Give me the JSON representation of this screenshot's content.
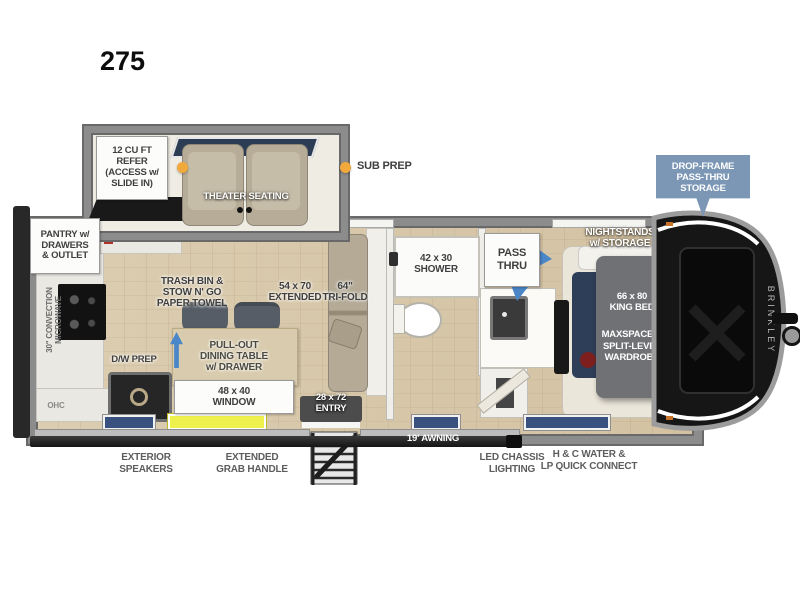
{
  "header": {
    "model": "275"
  },
  "legend": {
    "sub_prep": "SUB PREP"
  },
  "badge": {
    "drop_frame": [
      "DROP-FRAME",
      "PASS-THRU",
      "STORAGE"
    ]
  },
  "rooms": {
    "living": {
      "refer": [
        "12 CU FT",
        "REFER",
        "(ACCESS w/",
        "SLIDE IN)"
      ],
      "theater": "THEATER SEATING",
      "sofa_extended": [
        "54 x 70",
        "EXTENDED"
      ],
      "sofa_trifold": [
        "64\"",
        "TRI-FOLD"
      ]
    },
    "kitchen": {
      "pantry": [
        "PANTRY w/",
        "DRAWERS",
        "& OUTLET"
      ],
      "microwave": [
        "30\" CONVECTION",
        "MICROWAVE"
      ],
      "ohc": "OHC",
      "trash": [
        "TRASH BIN &",
        "STOW N' GO",
        "PAPER TOWEL"
      ],
      "dw_prep": "D/W PREP",
      "dining": [
        "PULL-OUT",
        "DINING TABLE",
        "w/ DRAWER"
      ],
      "window": [
        "48 x 40",
        "WINDOW"
      ]
    },
    "entry": {
      "door": [
        "28 x 72",
        "ENTRY"
      ]
    },
    "bath": {
      "shower": [
        "42 x 30",
        "SHOWER"
      ],
      "pass_thru": [
        "PASS",
        "THRU"
      ]
    },
    "bedroom": {
      "nightstands": [
        "NIGHTSTANDS",
        "w/ STORAGE"
      ],
      "bed": [
        "66 x 80",
        "KING BED"
      ],
      "wardrobe": [
        "MAXSPACE™",
        "SPLIT-LEVEL",
        "WARDROBE"
      ]
    }
  },
  "exterior": {
    "awning": "19' AWNING",
    "speakers": [
      "EXTERIOR",
      "SPEAKERS"
    ],
    "grab_handle": [
      "EXTENDED",
      "GRAB HANDLE"
    ],
    "chassis_lighting": [
      "LED CHASSIS",
      "LIGHTING"
    ],
    "water": [
      "H & C WATER &",
      "LP QUICK CONNECT"
    ],
    "brand": "BRINKLEY"
  },
  "colors": {
    "accent_blue": "#4a86c8",
    "badge_blue": "#7b97b5",
    "highlight_yellow": "#eef04c",
    "sub_prep_orange": "#f2a93b",
    "wall_gray": "#8c8c8c",
    "floor_wood": "#d7c6a8",
    "window_navy": "#39517e"
  }
}
